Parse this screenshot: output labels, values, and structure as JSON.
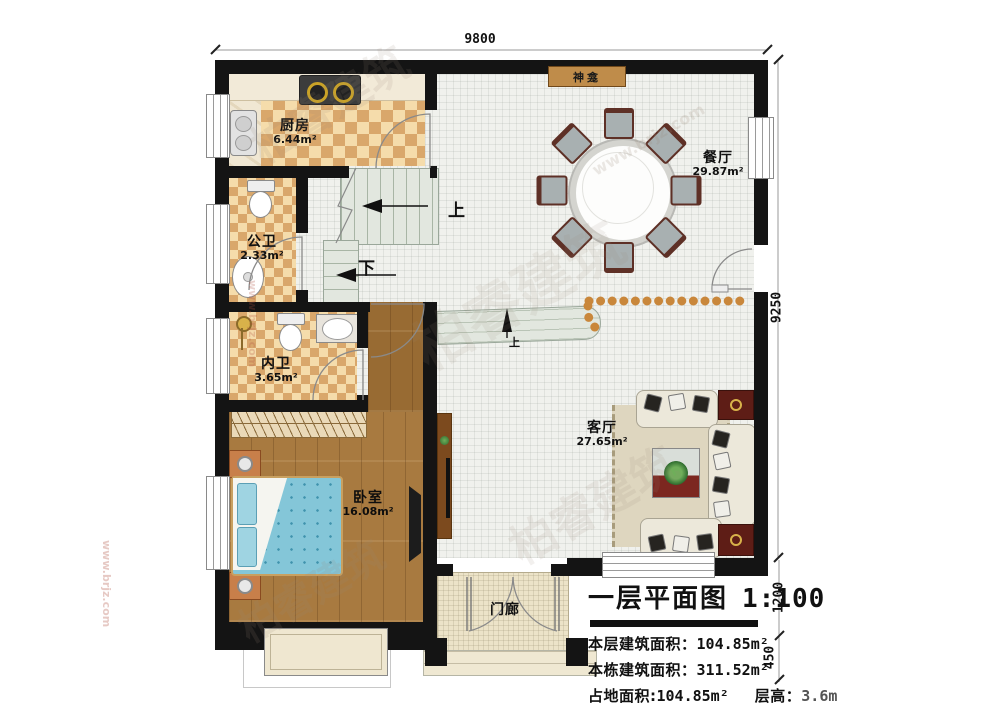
{
  "plan": {
    "rooms": [
      {
        "name": "厨房",
        "area": "6.44m²"
      },
      {
        "name": "公卫",
        "area": "2.33m²"
      },
      {
        "name": "内卫",
        "area": "3.65m²"
      },
      {
        "name": "卧室",
        "area": "16.08m²"
      },
      {
        "name": "餐厅",
        "area": "29.87m²"
      },
      {
        "name": "客厅",
        "area": "27.65m²"
      },
      {
        "name": "门廊",
        "area": ""
      }
    ],
    "shrine": "神龛",
    "stair_up": "上",
    "stair_down": "下",
    "step_up": "上"
  },
  "dimensions": {
    "top": "9800",
    "right": "9250",
    "lower_right": "1200",
    "bottom_right": "450"
  },
  "title_block": {
    "title": "一层平面图",
    "scale": "1:100",
    "lines": [
      {
        "label": "本层建筑面积：",
        "value": "104.85m²"
      },
      {
        "label": "本栋建筑面积：",
        "value": "311.52m²"
      },
      {
        "label": "占地面积:",
        "value": "104.85m²"
      }
    ],
    "height_label": "层高：",
    "height_value": "3.6m"
  },
  "watermark": {
    "brand": "柏睿建筑",
    "site": "www.brjz.com"
  }
}
